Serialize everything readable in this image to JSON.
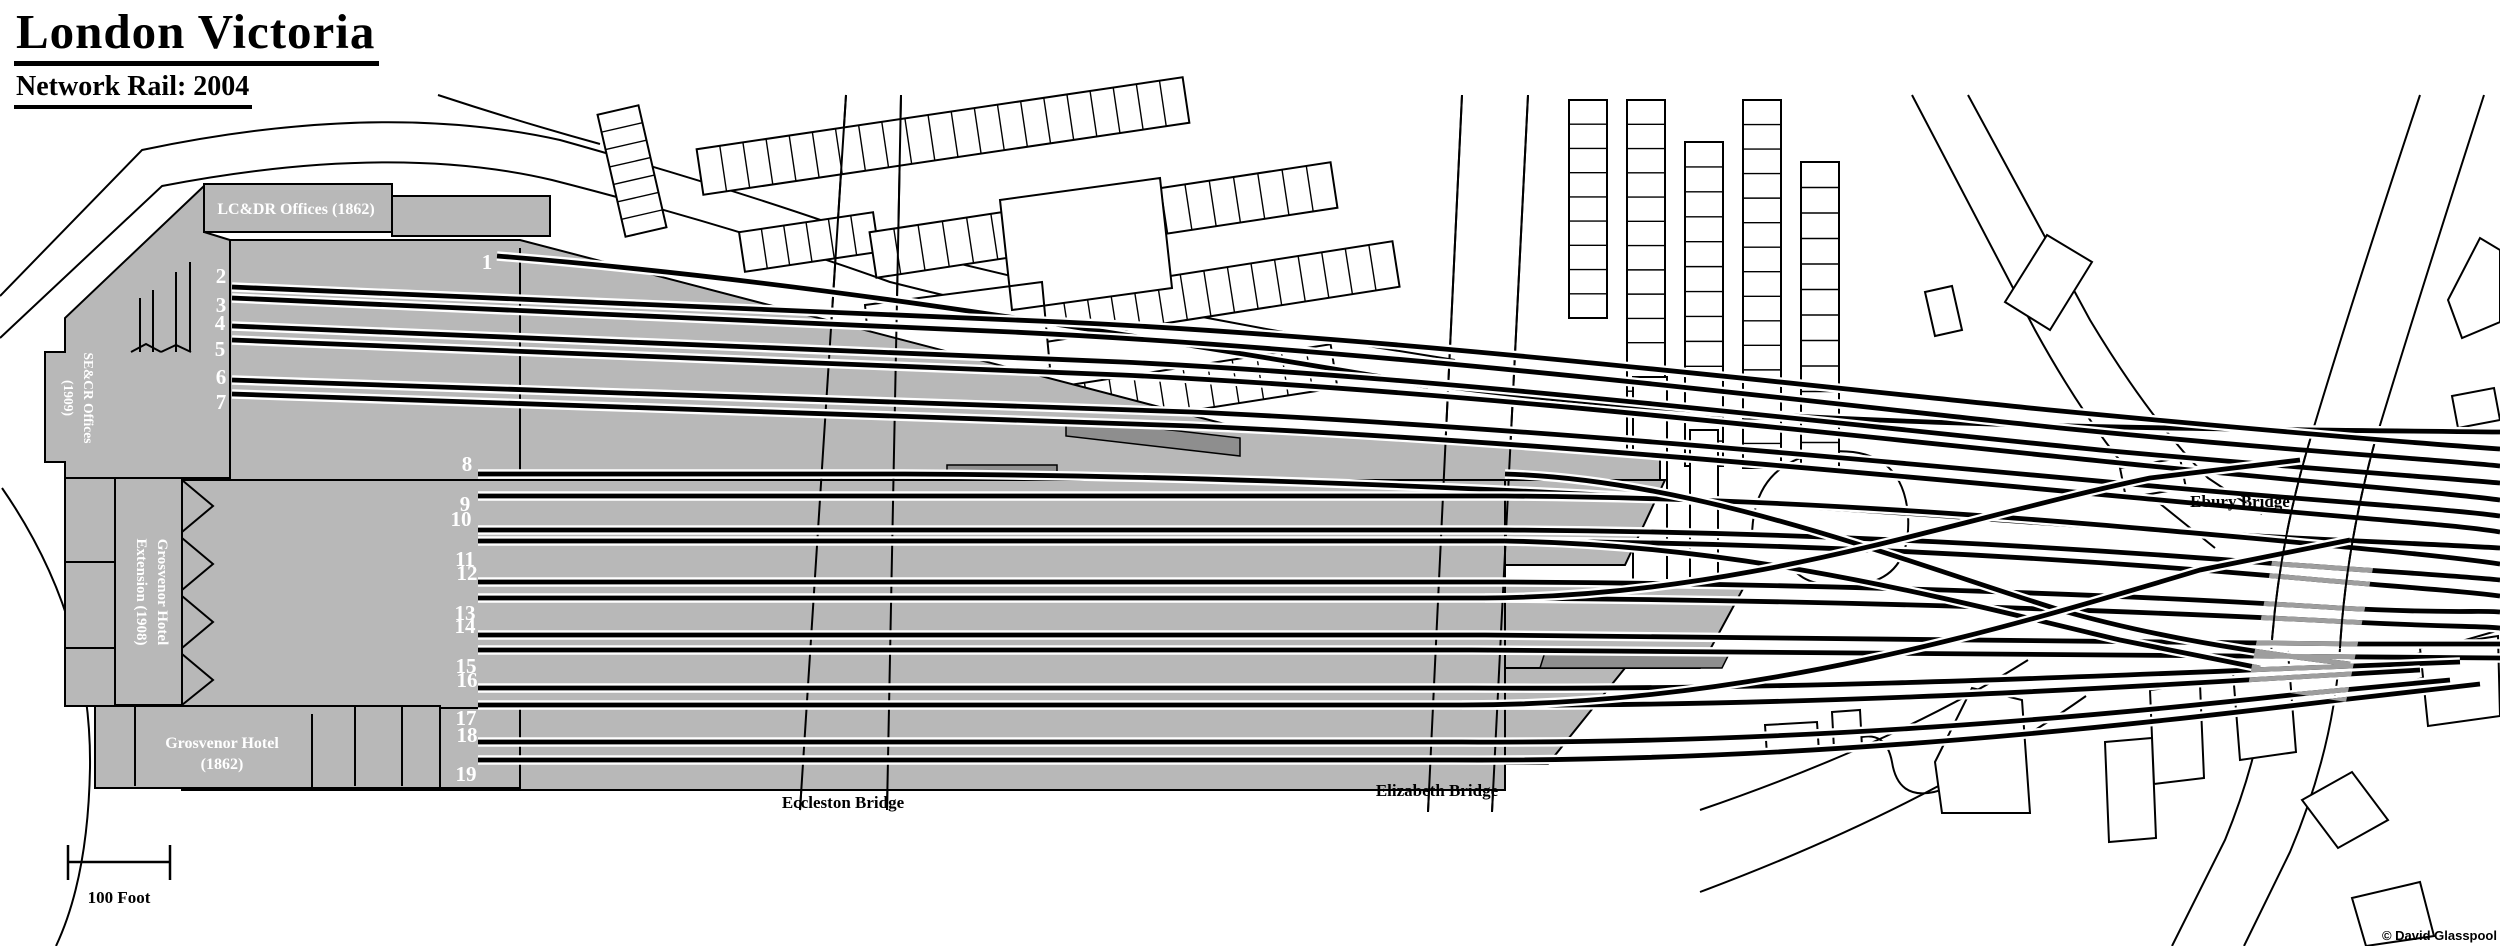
{
  "title": {
    "main": "London Victoria",
    "subtitle": "Network Rail: 2004"
  },
  "station": {
    "lcdr_offices": "LC&DR Offices (1862)",
    "secr_offices_line1": "SE&CR Offices",
    "secr_offices_line2": "(1909)",
    "grosvenor_ext_line1": "Grosvenor Hotel",
    "grosvenor_ext_line2": "Extension (1908)",
    "grosvenor_hotel_line1": "Grosvenor Hotel",
    "grosvenor_hotel_line2": "(1862)"
  },
  "platforms": [
    "1",
    "2",
    "3",
    "4",
    "5",
    "6",
    "7",
    "8",
    "9",
    "10",
    "11",
    "12",
    "13",
    "14",
    "15",
    "16",
    "17",
    "18",
    "19"
  ],
  "bridges": {
    "eccleston": "Eccleston Bridge",
    "elizabeth": "Elizabeth Bridge",
    "ebury": "Ebury Bridge"
  },
  "scale_label": "100 Foot",
  "credit": "© David Glasspool",
  "colors": {
    "station_gray": "#b8b8b8",
    "canopy_gray": "#8e8e8e",
    "bridge_track_gray": "#9e9e9e",
    "track_black": "#000000",
    "background": "#ffffff"
  }
}
